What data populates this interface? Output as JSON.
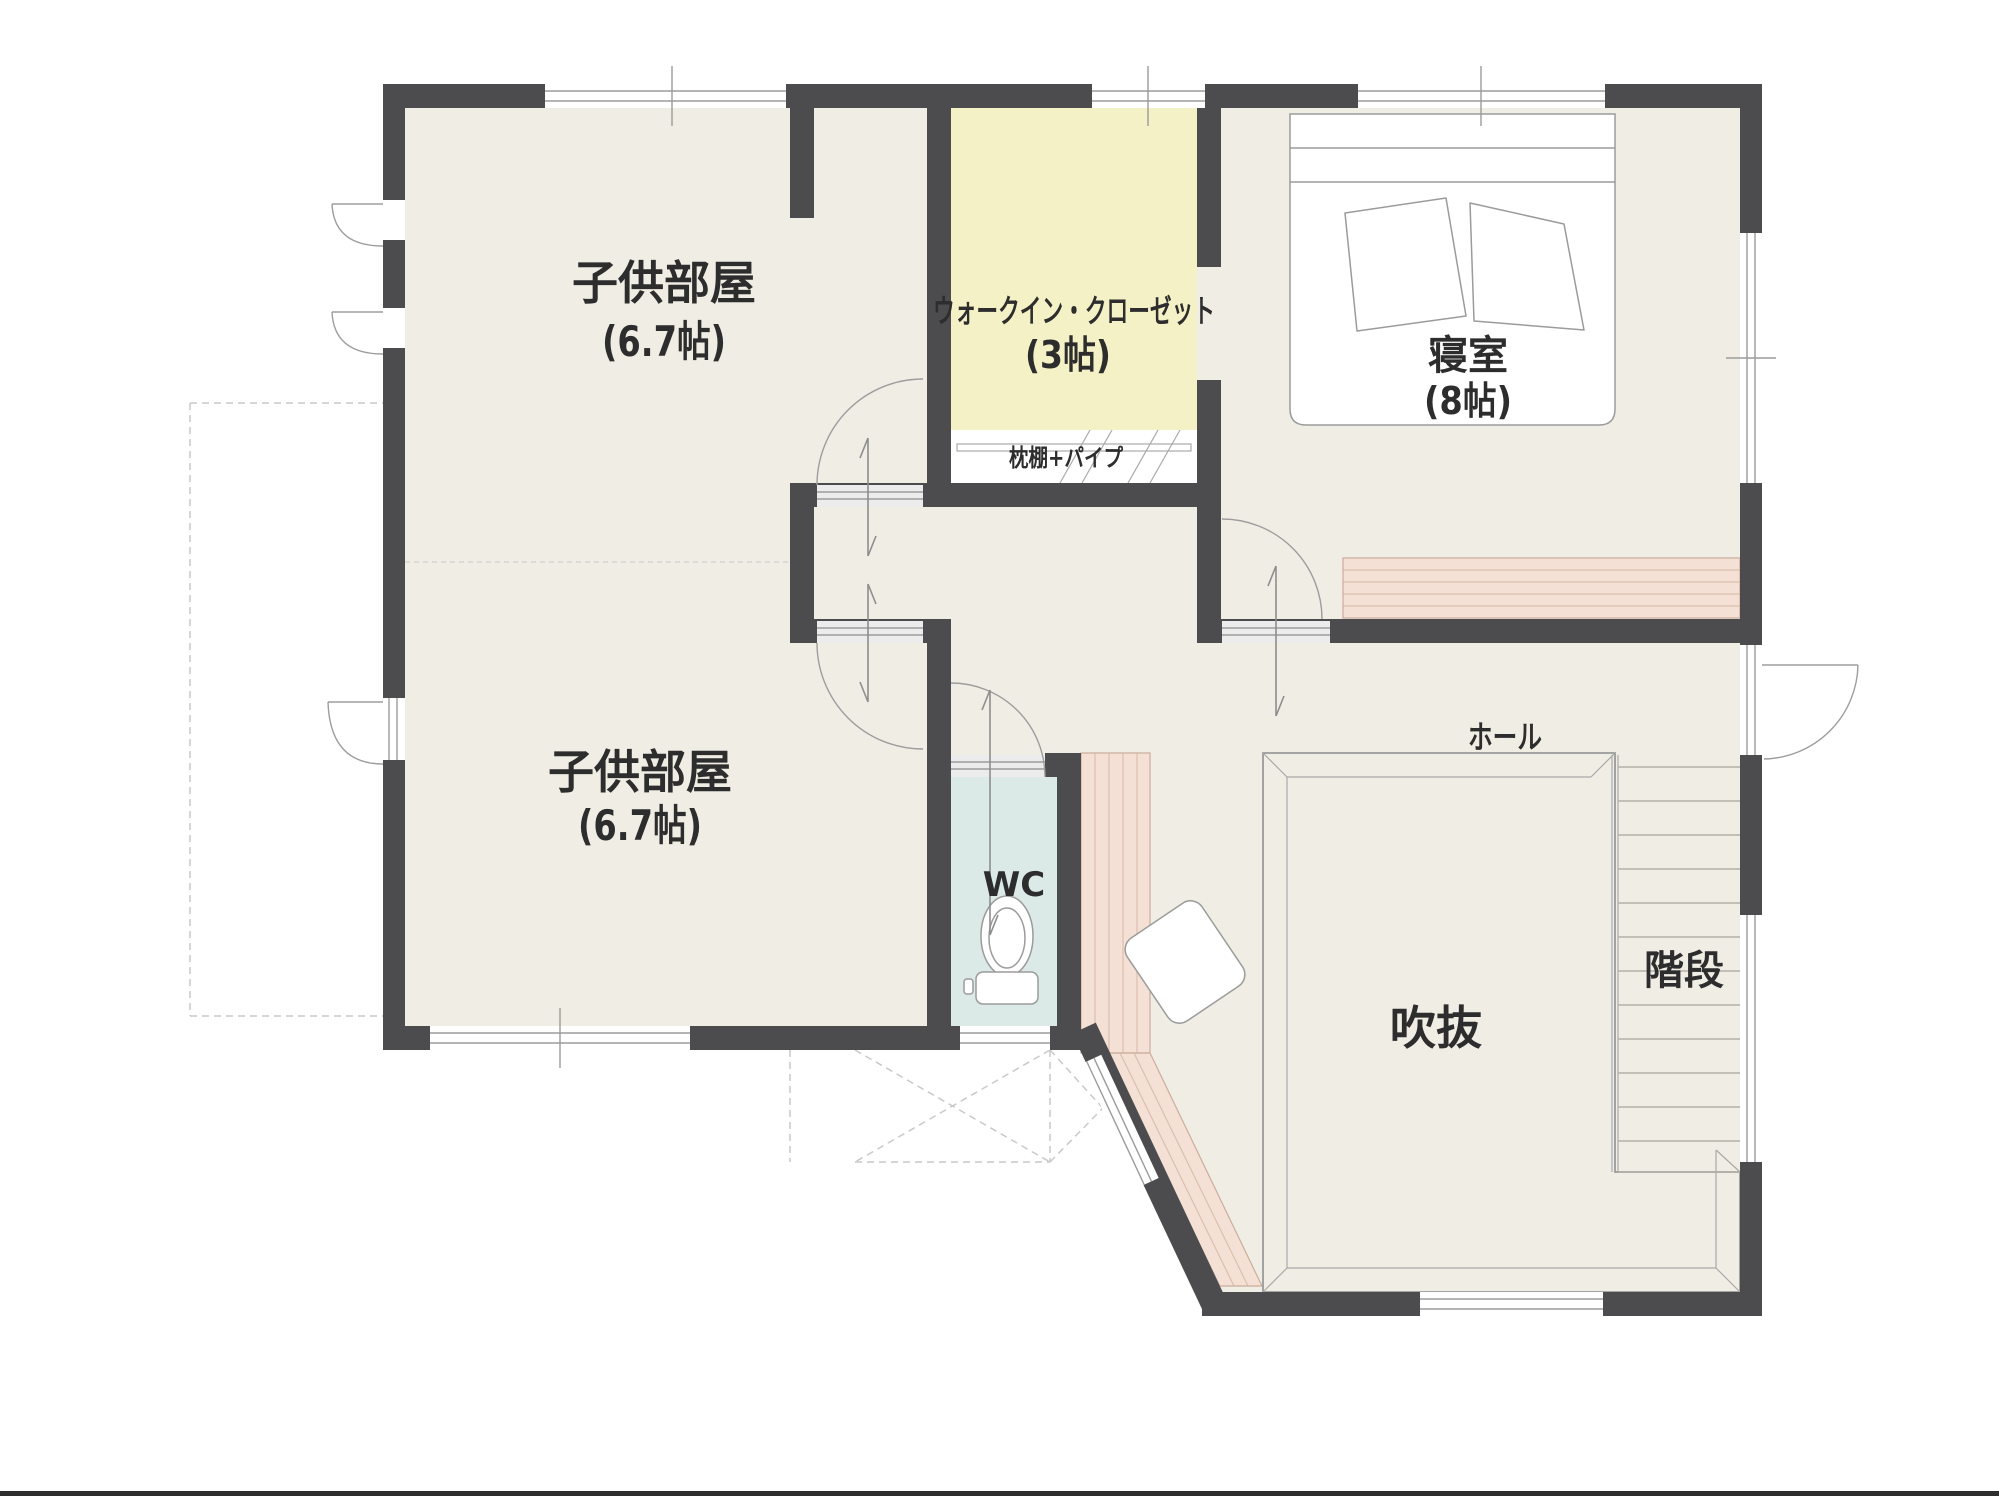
{
  "floor_plan": {
    "labels": {
      "kids_room_1": {
        "name": "子供部屋",
        "size": "(6.7帖)"
      },
      "kids_room_2": {
        "name": "子供部屋",
        "size": "(6.7帖)"
      },
      "walk_in_closet": {
        "name": "ウォークイン・クローゼット",
        "size": "(3帖)",
        "shelf_note": "枕棚+パイプ"
      },
      "bedroom": {
        "name": "寝室",
        "size": "(8帖)"
      },
      "wc": {
        "name": "WC"
      },
      "hall": {
        "name": "ホール"
      },
      "void": {
        "name": "吹抜"
      },
      "stairs": {
        "name": "階段"
      }
    },
    "colors": {
      "wall": "#4c4c4e",
      "floor": "#f0ede4",
      "wic": "#f5f1c6",
      "wc": "#dbe9e7",
      "counter": "#f4e0d5",
      "void": "#ffffff",
      "page_line": "#2e2e2e"
    }
  }
}
